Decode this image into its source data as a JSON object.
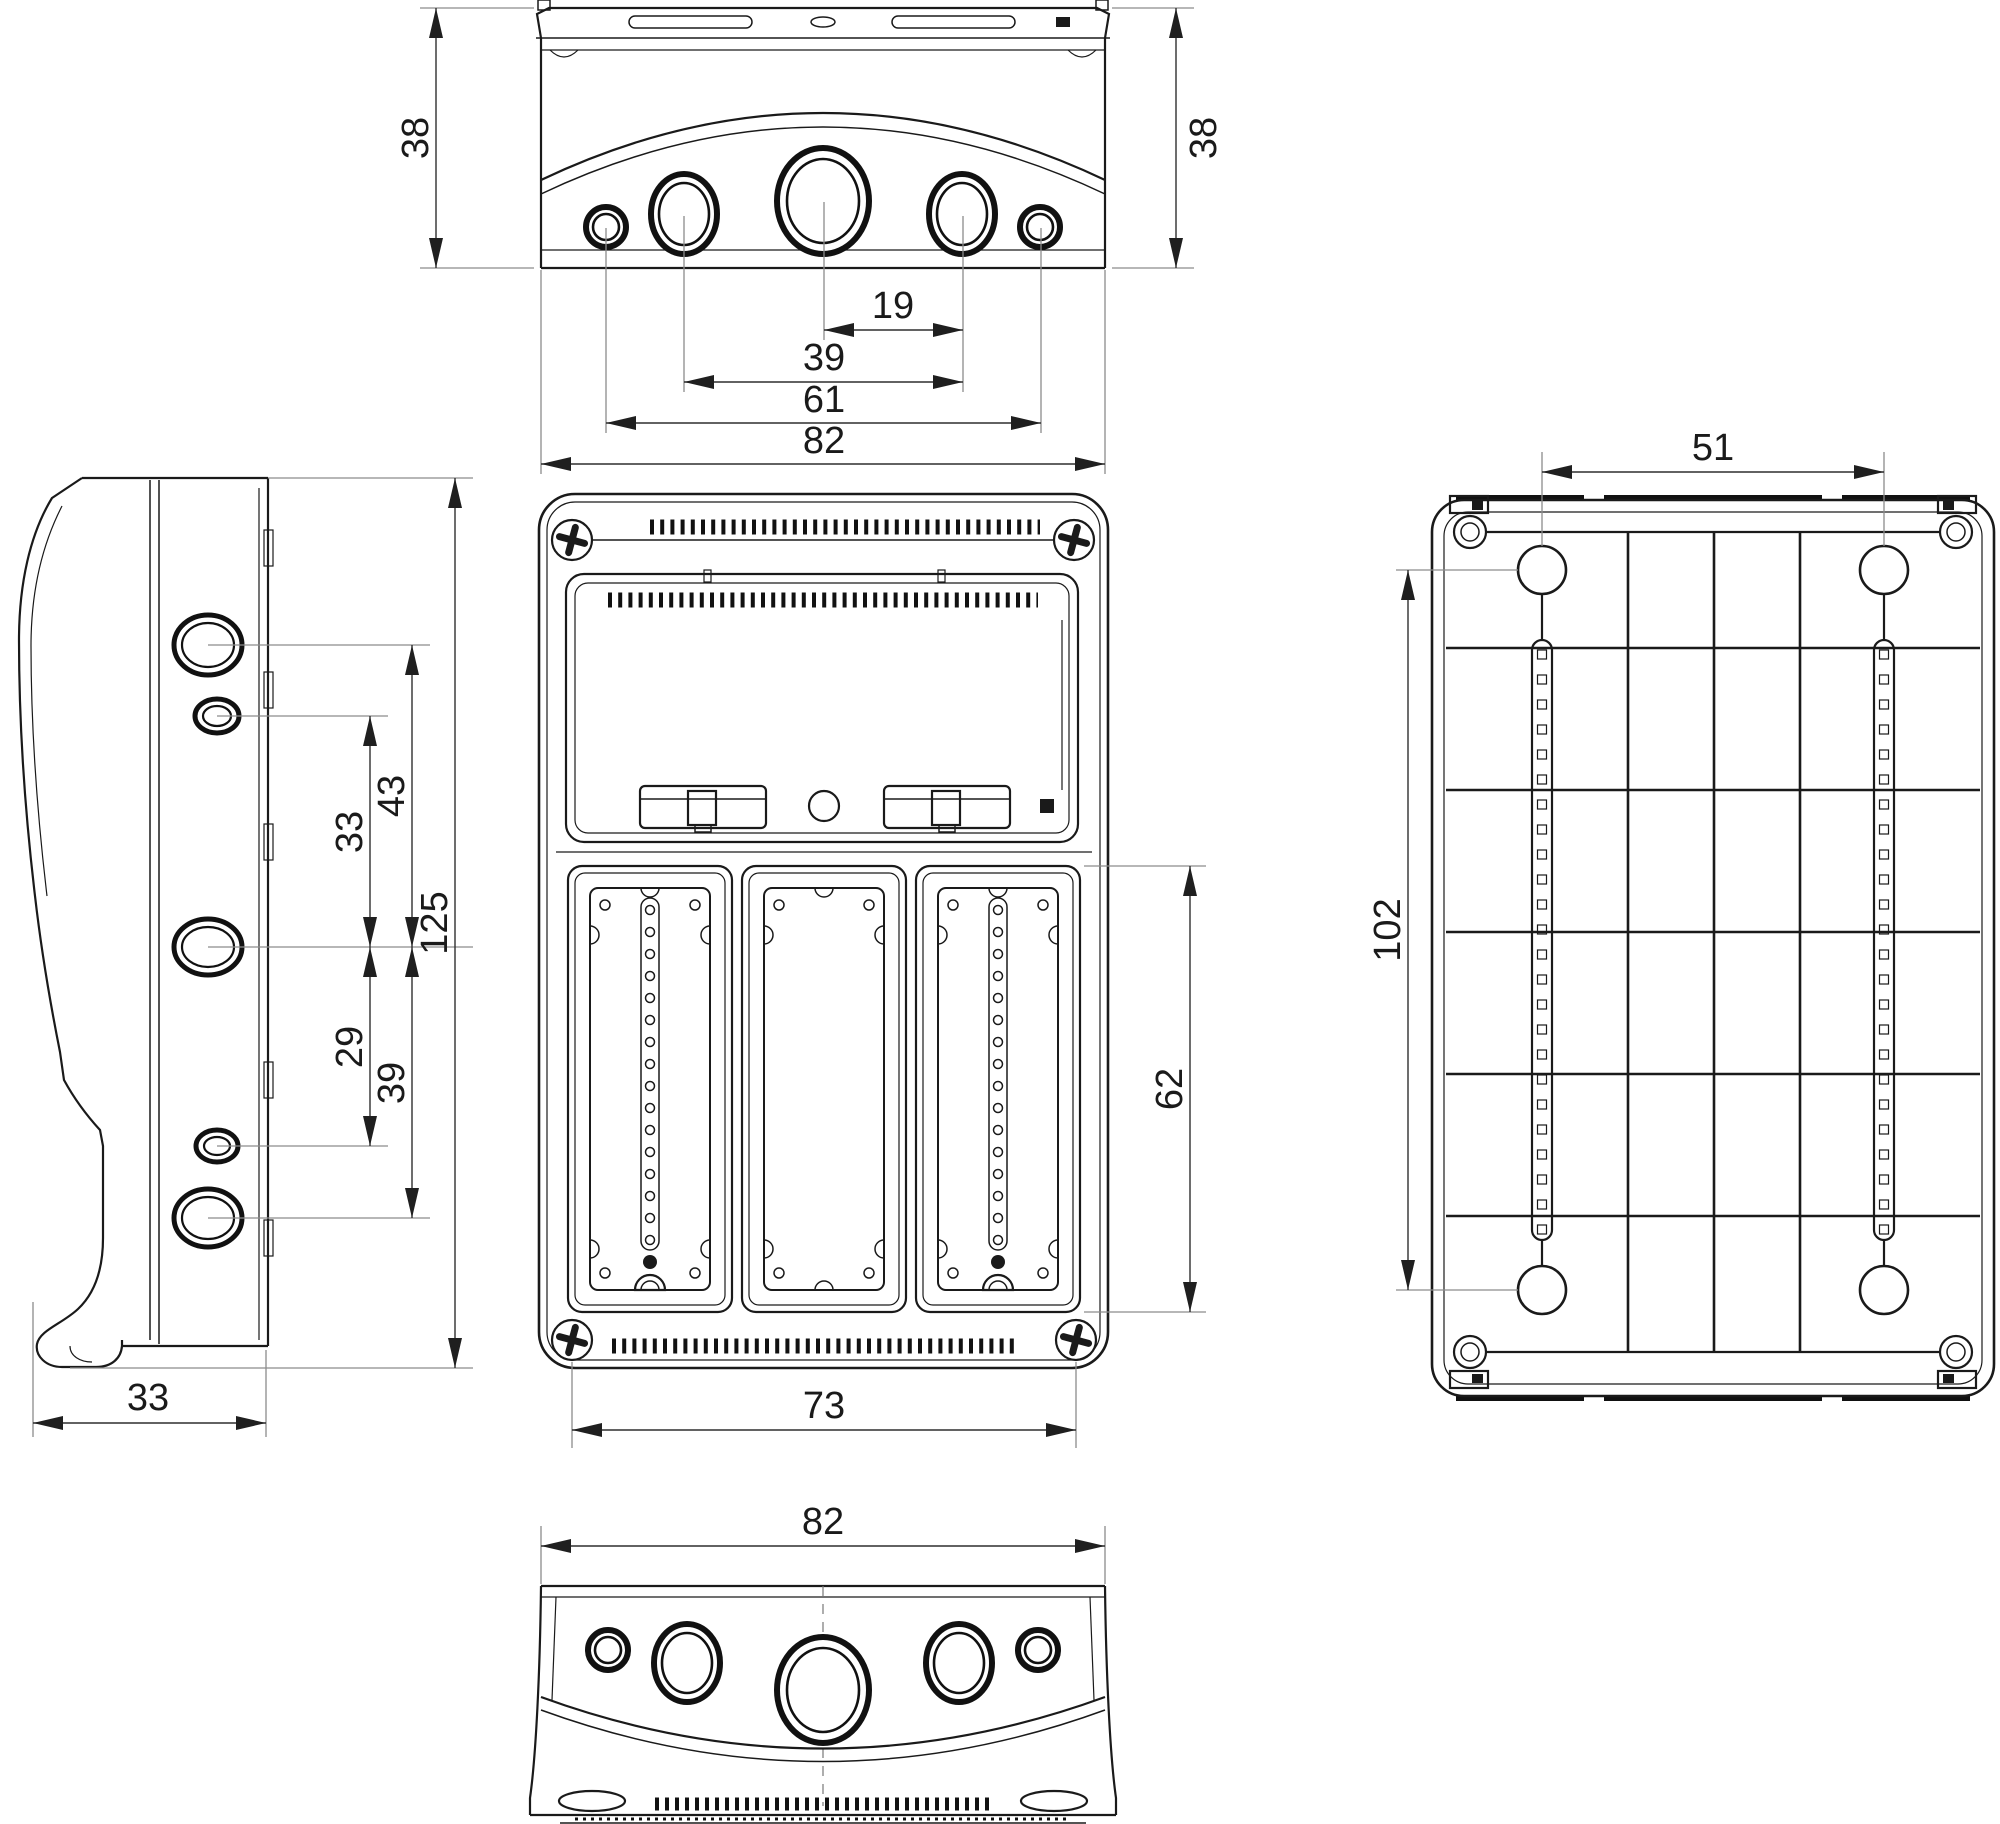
{
  "colors": {
    "ink": "#1a1a1a",
    "dimension_line": "#2f2f2f",
    "extension_line": "#8c8c8c",
    "background": "#ffffff"
  },
  "views": {
    "top": {
      "dims": {
        "height_left": "38",
        "height_right": "38",
        "pitch_19": "19",
        "pitch_39": "39",
        "pitch_61": "61",
        "width_82": "82"
      }
    },
    "side": {
      "dims": {
        "dist_43": "43",
        "dist_33": "33",
        "dist_29": "29",
        "dist_39": "39",
        "height_125": "125",
        "depth_33": "33"
      }
    },
    "front": {
      "dims": {
        "cutout_height_62": "62",
        "screw_span_73": "73"
      }
    },
    "back": {
      "dims": {
        "hole_span_51": "51",
        "hole_span_102": "102"
      }
    },
    "bottom": {
      "dims": {
        "width_82": "82"
      }
    }
  }
}
